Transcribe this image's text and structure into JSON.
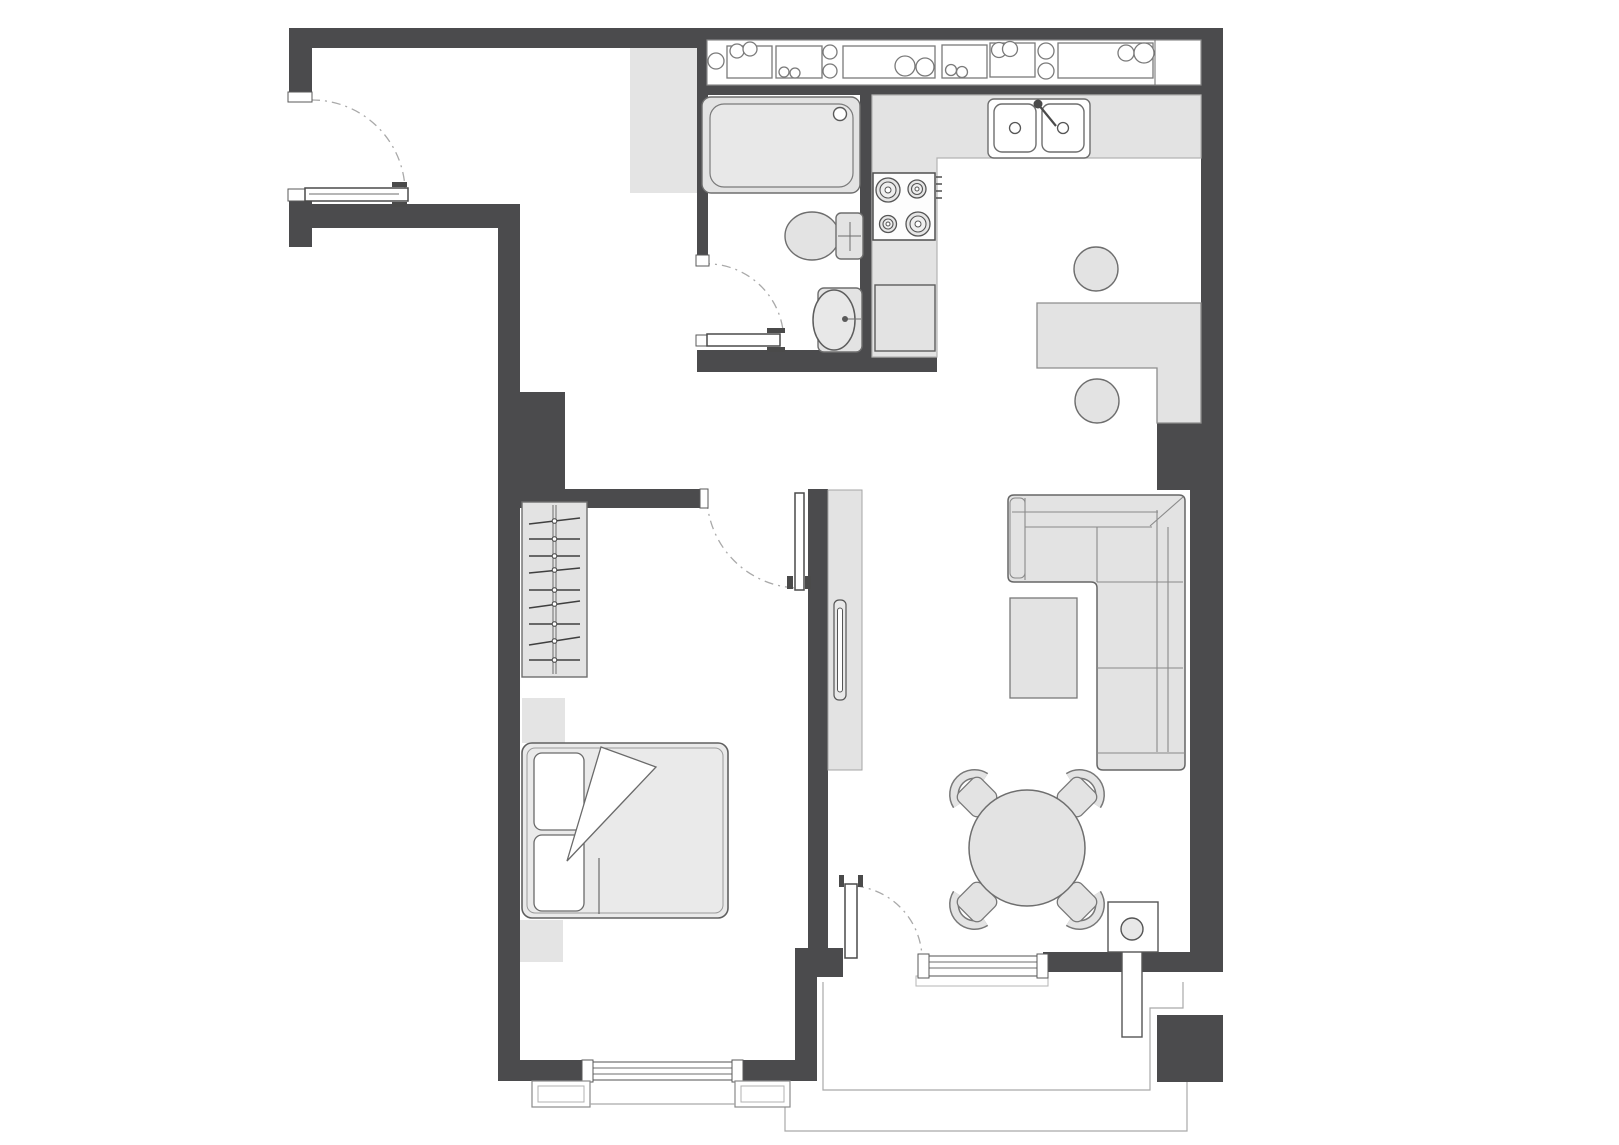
{
  "title": "apartment-floor-plan",
  "colors": {
    "background": "#ffffff",
    "wall": "#4b4b4d",
    "furniture": "#e3e3e3",
    "furniture_borderless": "#e4e4e4",
    "bed_fill": "#eaeaea",
    "outline": "#6e6e6e",
    "outline_light": "#a9a9a9",
    "white": "#ffffff"
  },
  "rooms": {
    "entrance_hall": {
      "label": "entrance-hall",
      "features": [
        "entrance-door",
        "storage-area"
      ]
    },
    "bathroom": {
      "label": "bathroom",
      "fixtures": [
        "bathtub",
        "toilet",
        "washbasin",
        "bathroom-door"
      ]
    },
    "kitchen": {
      "label": "kitchen",
      "fixtures": [
        "upper-cabinet-band",
        "l-shaped-counter",
        "double-sink",
        "hob-four-burners",
        "oven",
        "bar-counter",
        "bar-stool-1",
        "bar-stool-2"
      ]
    },
    "living_room": {
      "label": "living-room",
      "furniture": [
        "corner-sofa",
        "coffee-table",
        "tv-unit",
        "round-dining-table",
        "dining-chair-1",
        "dining-chair-2",
        "dining-chair-3",
        "dining-chair-4",
        "balcony-door",
        "window",
        "utility-fixture-with-pipe"
      ]
    },
    "bedroom": {
      "label": "bedroom",
      "furniture": [
        "wardrobe-with-hangers",
        "dresser",
        "double-bed",
        "pillows",
        "duvet-fold",
        "nightstand",
        "bedroom-door",
        "window"
      ]
    },
    "balcony": {
      "label": "balcony",
      "features": [
        "railing-outline",
        "window-sill-boxes"
      ]
    }
  }
}
